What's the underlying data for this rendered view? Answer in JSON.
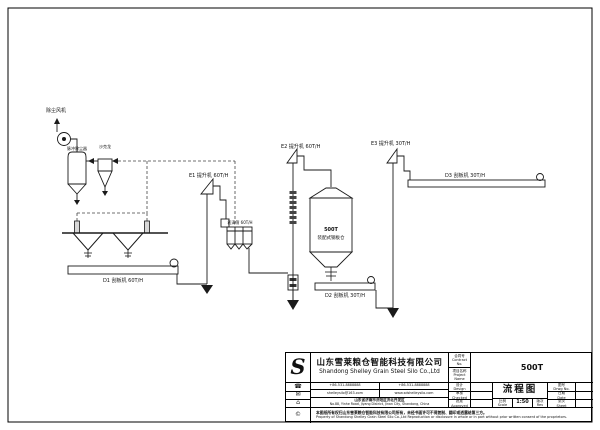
{
  "colors": {
    "ink": "#1a1a1a",
    "paper": "#ffffff"
  },
  "diagram": {
    "labels": {
      "fan": "除尘风机",
      "pulse_filter": "脉冲除尘器",
      "cyclone": "沙克龙",
      "elevator_e1": "E1 提升机 60T/H",
      "sieve": "初清筛 60T/H",
      "conveyor_d1": "D1 刮板机 60T/H",
      "elevator_e2": "E2 提升机 60T/H",
      "silo_capacity": "500T",
      "silo_type": "装配式钢板仓",
      "conveyor_d2": "D2 刮板机 30T/H",
      "elevator_e3": "E3 提升机 30T/H",
      "conveyor_d3": "D3 刮板机 30T/H"
    }
  },
  "title_block": {
    "logo": "S",
    "company_cn": "山东雪莱粮仓智能科技有限公司",
    "company_en": "Shandong Shelley Grain Steel Silo Co.,Ltd",
    "fields": {
      "contract_label": "合同号\nContract No.",
      "project_label": "项目名称\nProject Name",
      "project_value": "500T",
      "design_label": "设计\nDesign",
      "checked_label": "审核\nChecked",
      "approved_label": "批准\nApproved",
      "drawing_title": "流程图",
      "scale_label": "比例\nScale",
      "scale_value": "1:50",
      "rev_label": "版次\nRev",
      "drawing_no_label": "图号\nDrwg No.",
      "date_label": "日期\nDate",
      "sheet_label": "张次\nSheet"
    },
    "contact": {
      "tel": "+86-531-8888888",
      "fax": "+86-531-8888888",
      "email": "shelleysilo@163.com",
      "web": "www.sdshelleysilo.com",
      "address_cn": "山东省济南市济阳区济北开发区",
      "address_en": "No.88, Yinhe Road, Jiyang District, Jinan City, Shandong, China"
    },
    "icons": {
      "tel": "☎",
      "mail": "✉",
      "home": "⌂",
      "copyright": "©"
    },
    "disclaimer_cn": "本图纸所有权归山东雪莱粮仓智能科技有限公司所有，未经书面许可不得复制、翻印或透露给第三方。",
    "disclaimer_en": "Property of Shandong Shelley Grain Steel Silo Co.,Ltd Reproduction or disclosure in whole or in part without prior written consent of the proprietors."
  }
}
